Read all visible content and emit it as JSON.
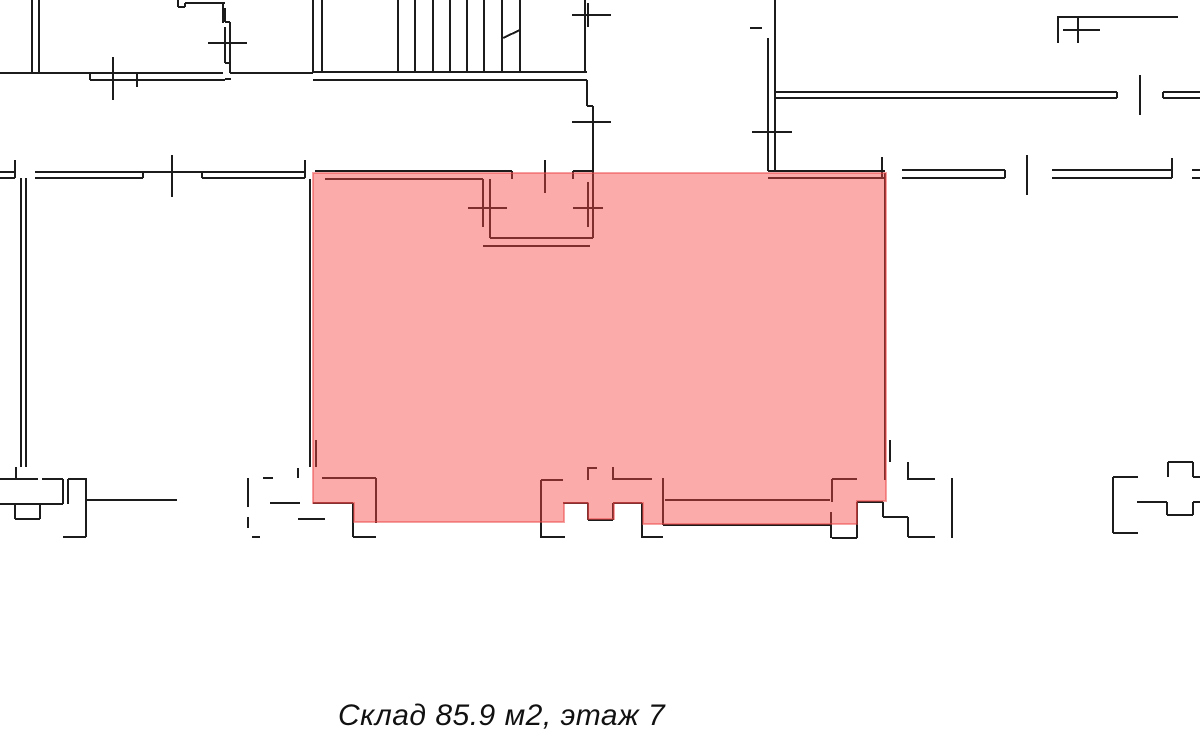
{
  "page": {
    "background": "#ffffff",
    "width": 1200,
    "height": 745
  },
  "caption": {
    "text": "Склад 85.9 м2, этаж 7",
    "color": "#111111"
  },
  "unit": {
    "type_label": "Склад",
    "area_m2": "85.9",
    "floor": "7"
  },
  "floor_plan": {
    "wall_color": "#1c1c1c",
    "wall_width": 2,
    "tick_width": 1.7,
    "highlight": {
      "label": "warehouse-highlight",
      "fill": "rgba(248,68,68,0.45)",
      "stroke": "rgba(235,70,70,0.5)",
      "polygon": [
        [
          313,
          173
        ],
        [
          886,
          173
        ],
        [
          886,
          501
        ],
        [
          857,
          501
        ],
        [
          857,
          524
        ],
        [
          643,
          524
        ],
        [
          643,
          503
        ],
        [
          614,
          503
        ],
        [
          614,
          519
        ],
        [
          588,
          519
        ],
        [
          588,
          503
        ],
        [
          564,
          503
        ],
        [
          564,
          522
        ],
        [
          354,
          522
        ],
        [
          354,
          503
        ],
        [
          313,
          503
        ]
      ]
    },
    "walls": [
      [
        32,
        0,
        32,
        73
      ],
      [
        39,
        0,
        39,
        73
      ],
      [
        0,
        73,
        223,
        73
      ],
      [
        90,
        80,
        225,
        80
      ],
      [
        90,
        73,
        90,
        80
      ],
      [
        225,
        79,
        231,
        79
      ],
      [
        230,
        73,
        313,
        73
      ],
      [
        178,
        0,
        178,
        7
      ],
      [
        178,
        7,
        185,
        7
      ],
      [
        185,
        3,
        185,
        7
      ],
      [
        185,
        3,
        225,
        3
      ],
      [
        223,
        3,
        223,
        23
      ],
      [
        225,
        8,
        225,
        22
      ],
      [
        225,
        22,
        230,
        22
      ],
      [
        230,
        22,
        230,
        73
      ],
      [
        225,
        27,
        225,
        63
      ],
      [
        225,
        63,
        230,
        63
      ],
      [
        313,
        0,
        313,
        72
      ],
      [
        322,
        0,
        322,
        72
      ],
      [
        313,
        72,
        587,
        72
      ],
      [
        313,
        80,
        587,
        80
      ],
      [
        398,
        0,
        398,
        72
      ],
      [
        415,
        0,
        415,
        72
      ],
      [
        433,
        0,
        433,
        72
      ],
      [
        450,
        0,
        450,
        72
      ],
      [
        467,
        0,
        467,
        72
      ],
      [
        484,
        0,
        484,
        72
      ],
      [
        502,
        0,
        502,
        72
      ],
      [
        520,
        0,
        520,
        72
      ],
      [
        503,
        38,
        520,
        30
      ],
      [
        585,
        0,
        585,
        72
      ],
      [
        587,
        80,
        587,
        106
      ],
      [
        587,
        106,
        593,
        106
      ],
      [
        593,
        106,
        593,
        171
      ],
      [
        775,
        0,
        775,
        38
      ],
      [
        768,
        38,
        768,
        171
      ],
      [
        775,
        38,
        775,
        171
      ],
      [
        775,
        92,
        1117,
        92
      ],
      [
        775,
        98,
        1117,
        98
      ],
      [
        1117,
        92,
        1117,
        98
      ],
      [
        1163,
        92,
        1200,
        92
      ],
      [
        1163,
        98,
        1200,
        98
      ],
      [
        1163,
        92,
        1163,
        98
      ],
      [
        1057,
        17,
        1178,
        17
      ],
      [
        1058,
        17,
        1058,
        43
      ],
      [
        0,
        172,
        15,
        172
      ],
      [
        0,
        178,
        15,
        178
      ],
      [
        15,
        160,
        15,
        178
      ],
      [
        35,
        172,
        305,
        172
      ],
      [
        35,
        178,
        143,
        178
      ],
      [
        143,
        172,
        143,
        178
      ],
      [
        202,
        178,
        305,
        178
      ],
      [
        202,
        172,
        202,
        178
      ],
      [
        305,
        160,
        305,
        178
      ],
      [
        21,
        178,
        21,
        467
      ],
      [
        26,
        178,
        26,
        467
      ],
      [
        310,
        179,
        310,
        467
      ],
      [
        316,
        440,
        316,
        467
      ],
      [
        315,
        171,
        512,
        171
      ],
      [
        512,
        171,
        512,
        179
      ],
      [
        325,
        179,
        483,
        179
      ],
      [
        573,
        171,
        573,
        179
      ],
      [
        573,
        171,
        592,
        171
      ],
      [
        483,
        179,
        483,
        227
      ],
      [
        490,
        179,
        490,
        238
      ],
      [
        588,
        182,
        588,
        227
      ],
      [
        593,
        171,
        593,
        238
      ],
      [
        490,
        238,
        593,
        238
      ],
      [
        483,
        246,
        590,
        246
      ],
      [
        768,
        171,
        885,
        171
      ],
      [
        768,
        178,
        885,
        178
      ],
      [
        882,
        157,
        882,
        178
      ],
      [
        902,
        170,
        1005,
        170
      ],
      [
        902,
        178,
        1005,
        178
      ],
      [
        1005,
        170,
        1005,
        178
      ],
      [
        1052,
        170,
        1172,
        170
      ],
      [
        1052,
        178,
        1172,
        178
      ],
      [
        1172,
        158,
        1172,
        178
      ],
      [
        1192,
        170,
        1200,
        170
      ],
      [
        1192,
        178,
        1200,
        178
      ],
      [
        885,
        173,
        885,
        480
      ],
      [
        890,
        440,
        890,
        462
      ],
      [
        322,
        478,
        376,
        478
      ],
      [
        376,
        478,
        376,
        523
      ],
      [
        313,
        503,
        353,
        503
      ],
      [
        353,
        503,
        353,
        537
      ],
      [
        353,
        537,
        376,
        537
      ],
      [
        541,
        480,
        541,
        538
      ],
      [
        541,
        480,
        563,
        480
      ],
      [
        541,
        537,
        565,
        537
      ],
      [
        588,
        467,
        588,
        480
      ],
      [
        588,
        468,
        597,
        468
      ],
      [
        613,
        467,
        613,
        480
      ],
      [
        613,
        479,
        652,
        479
      ],
      [
        563,
        503,
        588,
        503
      ],
      [
        588,
        503,
        588,
        520
      ],
      [
        588,
        520,
        613,
        520
      ],
      [
        613,
        503,
        613,
        520
      ],
      [
        613,
        503,
        642,
        503
      ],
      [
        642,
        503,
        642,
        538
      ],
      [
        642,
        537,
        663,
        537
      ],
      [
        663,
        478,
        663,
        525
      ],
      [
        663,
        525,
        830,
        525
      ],
      [
        665,
        500,
        830,
        500
      ],
      [
        831,
        512,
        831,
        538
      ],
      [
        832,
        538,
        857,
        538
      ],
      [
        857,
        525,
        857,
        538
      ],
      [
        832,
        479,
        857,
        479
      ],
      [
        832,
        479,
        832,
        502
      ],
      [
        857,
        502,
        883,
        502
      ],
      [
        857,
        502,
        857,
        525
      ],
      [
        883,
        502,
        883,
        517
      ],
      [
        883,
        517,
        908,
        517
      ],
      [
        908,
        517,
        908,
        537
      ],
      [
        908,
        537,
        935,
        537
      ],
      [
        908,
        462,
        908,
        480
      ],
      [
        908,
        479,
        935,
        479
      ],
      [
        952,
        478,
        952,
        538
      ],
      [
        16,
        467,
        16,
        479
      ],
      [
        0,
        479,
        38,
        479
      ],
      [
        42,
        479,
        63,
        479
      ],
      [
        63,
        479,
        63,
        504
      ],
      [
        0,
        504,
        63,
        504
      ],
      [
        15,
        504,
        15,
        519
      ],
      [
        40,
        504,
        40,
        519
      ],
      [
        15,
        519,
        40,
        519
      ],
      [
        68,
        479,
        68,
        504
      ],
      [
        68,
        479,
        87,
        479
      ],
      [
        86,
        479,
        86,
        537
      ],
      [
        63,
        537,
        86,
        537
      ],
      [
        87,
        500,
        177,
        500
      ],
      [
        248,
        478,
        248,
        507
      ],
      [
        248,
        517,
        248,
        528
      ],
      [
        263,
        478,
        273,
        478
      ],
      [
        298,
        468,
        298,
        478
      ],
      [
        270,
        503,
        300,
        503
      ],
      [
        252,
        537,
        260,
        537
      ],
      [
        298,
        519,
        325,
        519
      ],
      [
        1113,
        477,
        1113,
        533
      ],
      [
        1113,
        477,
        1138,
        477
      ],
      [
        1113,
        533,
        1138,
        533
      ],
      [
        1137,
        502,
        1167,
        502
      ],
      [
        1167,
        502,
        1167,
        515
      ],
      [
        1167,
        515,
        1193,
        515
      ],
      [
        1193,
        502,
        1193,
        515
      ],
      [
        1193,
        502,
        1200,
        502
      ],
      [
        1168,
        462,
        1168,
        477
      ],
      [
        1168,
        462,
        1193,
        462
      ],
      [
        1193,
        462,
        1193,
        477
      ],
      [
        1193,
        477,
        1200,
        477
      ]
    ],
    "ticks": [
      [
        113,
        57,
        113,
        100
      ],
      [
        137,
        72,
        137,
        87
      ],
      [
        208,
        43,
        247,
        43
      ],
      [
        572,
        15,
        611,
        15
      ],
      [
        588,
        3,
        588,
        27
      ],
      [
        572,
        122,
        611,
        122
      ],
      [
        752,
        132,
        792,
        132
      ],
      [
        750,
        28,
        762,
        28
      ],
      [
        1140,
        75,
        1140,
        115
      ],
      [
        1078,
        17,
        1078,
        43
      ],
      [
        1063,
        30,
        1100,
        30
      ],
      [
        172,
        155,
        172,
        197
      ],
      [
        468,
        208,
        507,
        208
      ],
      [
        573,
        208,
        603,
        208
      ],
      [
        545,
        160,
        545,
        193
      ],
      [
        1027,
        155,
        1027,
        195
      ]
    ]
  }
}
